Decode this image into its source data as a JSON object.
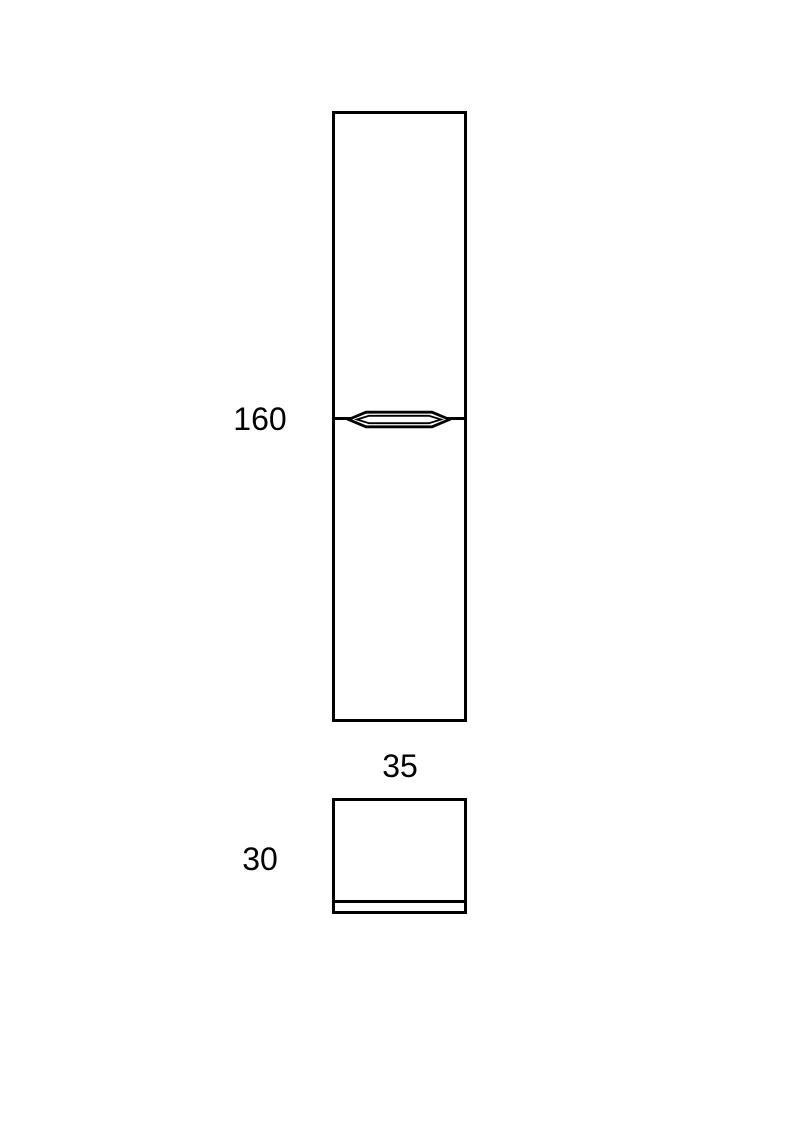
{
  "page": {
    "background": "#ffffff",
    "line_color": "#000000"
  },
  "diagram": {
    "type": "furniture-dimension-drawing",
    "views": {
      "front": "cabinet-front-elevation",
      "side": "cabinet-side-elevation"
    },
    "dimensions": {
      "height_label": "160",
      "width_label": "35",
      "depth_label": "30"
    }
  }
}
